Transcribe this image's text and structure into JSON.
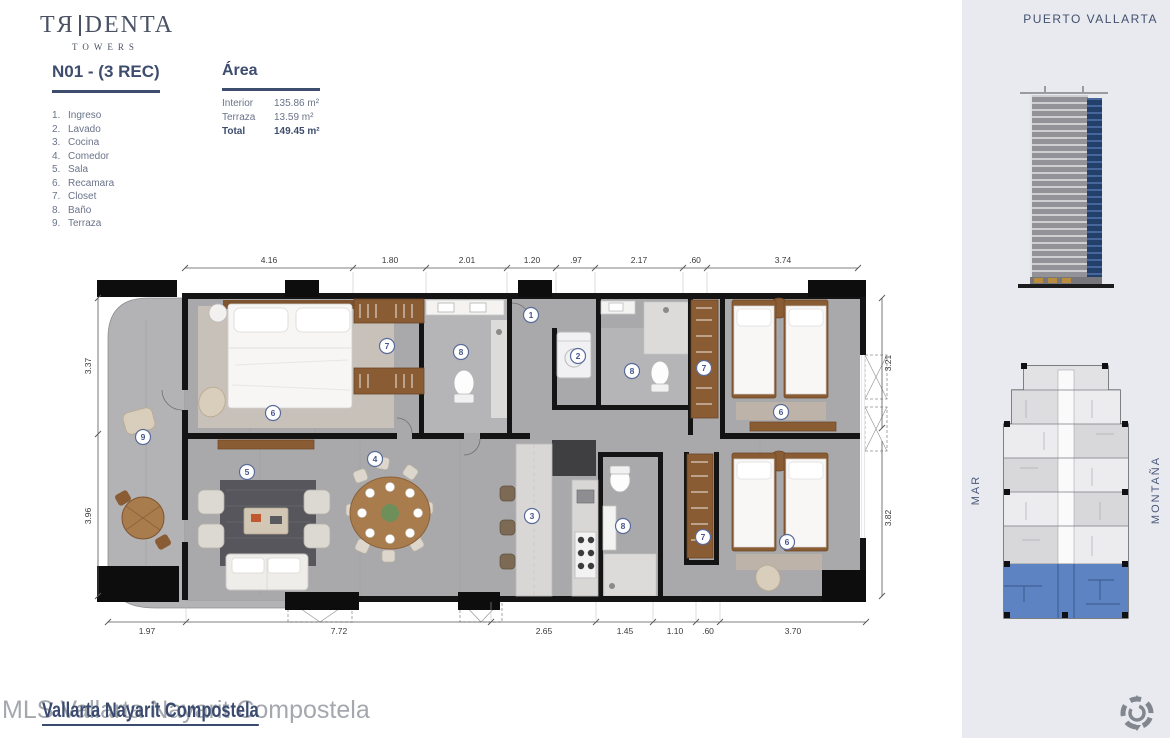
{
  "brand": {
    "logo_left": "TЯ",
    "logo_right": "DENTA",
    "logo_sub": "TOWERS"
  },
  "unit": {
    "title": "N01 - (3 REC)",
    "legend": [
      {
        "num": "1.",
        "label": "Ingreso"
      },
      {
        "num": "2.",
        "label": "Lavado"
      },
      {
        "num": "3.",
        "label": "Cocina"
      },
      {
        "num": "4.",
        "label": "Comedor"
      },
      {
        "num": "5.",
        "label": "Sala"
      },
      {
        "num": "6.",
        "label": "Recamara"
      },
      {
        "num": "7.",
        "label": "Closet"
      },
      {
        "num": "8.",
        "label": "Baño"
      },
      {
        "num": "9.",
        "label": "Terraza"
      }
    ]
  },
  "area": {
    "title": "Área",
    "rows": [
      {
        "label": "Interior",
        "value": "135.86 m²"
      },
      {
        "label": "Terraza",
        "value": "13.59 m²"
      },
      {
        "label": "Total",
        "value": "149.45 m²"
      }
    ]
  },
  "location": {
    "city": "PUERTO VALLARTA",
    "sea_label": "MAR",
    "mountain_label": "MONTAÑA"
  },
  "plan": {
    "dims_top": [
      "4.16",
      "1.80",
      "2.01",
      "1.20",
      ".97",
      "2.17",
      ".60",
      "3.74"
    ],
    "dims_bottom": [
      "1.97",
      "7.72",
      "2.65",
      "1.45",
      "1.10",
      ".60",
      "3.70"
    ],
    "dims_left": [
      "3.37",
      "3.96"
    ],
    "dims_right": [
      "3.21",
      "3.82"
    ],
    "markers": [
      {
        "label": "1",
        "room": "ingreso"
      },
      {
        "label": "2",
        "room": "lavado"
      },
      {
        "label": "8",
        "room": "bano-central"
      },
      {
        "label": "7",
        "room": "closet-norte"
      },
      {
        "label": "6",
        "room": "recamara-norte"
      },
      {
        "label": "7",
        "room": "closet-principal"
      },
      {
        "label": "8",
        "room": "bano-principal"
      },
      {
        "label": "6",
        "room": "recamara-principal"
      },
      {
        "label": "9",
        "room": "terraza"
      },
      {
        "label": "5",
        "room": "sala"
      },
      {
        "label": "4",
        "room": "comedor"
      },
      {
        "label": "3",
        "room": "cocina"
      },
      {
        "label": "8",
        "room": "bano-sur"
      },
      {
        "label": "7",
        "room": "closet-sur"
      },
      {
        "label": "6",
        "room": "recamara-sur"
      }
    ]
  },
  "watermark": {
    "gray_text": "MLS Vallarta Nayarit Compostela",
    "link_text": "Vallarta Nayarit Compostela"
  },
  "footer": {
    "brand": "DOMUS",
    "tagline": "FINE REAL ESTATE"
  },
  "colors": {
    "accent_navy": "#3e4d6e",
    "panel_bg": "#e8eaef",
    "highlight_unit_blue": "#5e83c2",
    "floor_gray": "#a9a9ab",
    "wall_black": "#141414",
    "wood_brown": "#8a5c34"
  }
}
